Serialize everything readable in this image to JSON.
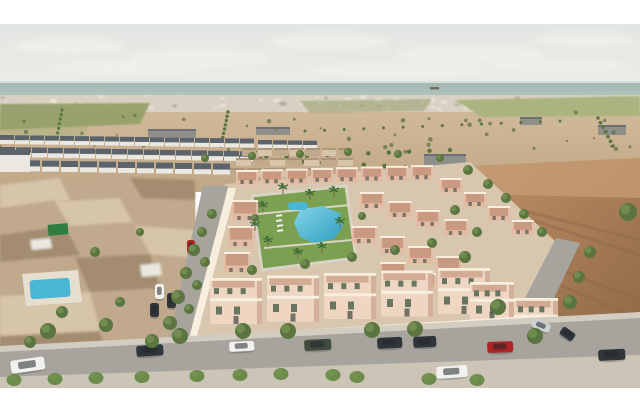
{
  "scene": {
    "type": "aerial-architectural-rendering",
    "subject": "new salmon-coloured villa development with communal pool and park, beside an older town, empty desert plots, distant white town and sea horizon"
  },
  "palette": {
    "frame": "#ffffff",
    "sky_top": "#e2e6e2",
    "sky_bottom": "#edece7",
    "cloud": "#f3f1ec",
    "sea": "#9fb5ae",
    "sea_light": "#b2c4bd",
    "horizon_haze": "#e9ebe3",
    "distant_town": "#d7d0c3",
    "speck_light": "#eae4d7",
    "speck_dark": "#b3ab9c",
    "field_green": "#96a06a",
    "field_green2": "#a9b37c",
    "desert_tan": "#d0b999",
    "desert_tan2": "#c0a685",
    "scrub_dark": "#6d7950",
    "warehouse_grey": "#90908b",
    "roof_dark": "#5c636b",
    "townhouse_white": "#eae8e1",
    "oldtown_brown": "#c0a98c",
    "oldtown_dark": "#a38c6f",
    "oldtown_light": "#d7c5aa",
    "shed_green": "#2f7d3f",
    "road_grey": "#a7a49e",
    "sidewalk": "#d3ccc0",
    "sidewalk_light": "#cbc4b7",
    "dev_ground": "#d9c6af",
    "villa_wall": "#e2bca4",
    "villa_wall_light": "#eed6c2",
    "villa_roof": "#c4937c",
    "villa_trim": "#f7eedd",
    "villa_shadow": "#c08f7a",
    "window_green": "#68765f",
    "window_dark": "#3e4741",
    "lawn": "#7ba052",
    "lawn_light": "#97b66a",
    "path_col": "#d9d3c6",
    "pool_blue": "#49b7d4",
    "pool_deep": "#2d9ec0",
    "pool_light": "#85d5e6",
    "pool_deck": "#e6dfd0",
    "tree_green": "#5a7540",
    "tree_light": "#7b9554",
    "trunk": "#7c644a",
    "palm_green": "#3f6d38",
    "bush_green": "#6b8c4b",
    "dirt_lot": "#aa7e57",
    "dirt_dark": "#8e6847",
    "dirt_light": "#c49b73",
    "car_white": "#f1f1ee",
    "car_red": "#b02424",
    "car_dark": "#2f353a",
    "car_green": "#414b3e",
    "car_silver": "#ccd1d3",
    "car_glass": "#20262a",
    "ship": "#6d6f6a"
  },
  "clouds": [
    [
      70,
      46,
      55,
      8
    ],
    [
      200,
      58,
      70,
      9
    ],
    [
      330,
      42,
      60,
      8
    ],
    [
      470,
      54,
      75,
      9
    ],
    [
      585,
      40,
      50,
      7
    ],
    [
      130,
      68,
      80,
      7
    ],
    [
      400,
      70,
      90,
      7
    ],
    [
      560,
      66,
      70,
      6
    ]
  ],
  "ship": {
    "x": 430,
    "y": 87,
    "w": 9,
    "h": 2.5
  },
  "specks": {
    "count": 85,
    "seed": 7
  },
  "scrub": {
    "count": 48,
    "seed": 13
  },
  "green_fields": [
    {
      "pts": "0,104 150,103 140,124 0,130",
      "c": "field_green",
      "o": 0.95
    },
    {
      "pts": "455,100 640,96 640,116 482,117",
      "c": "field_green2",
      "o": 0.95
    },
    {
      "pts": "300,101 432,99 424,111 310,113",
      "c": "field_green",
      "o": 0.55
    },
    {
      "pts": "0,130 90,126 80,140 0,144",
      "c": "field_green2",
      "o": 0.5
    }
  ],
  "warehouses": [
    {
      "x": 148,
      "y": 129,
      "w": 48,
      "h": 9
    },
    {
      "x": 256,
      "y": 127,
      "w": 34,
      "h": 8
    },
    {
      "x": 424,
      "y": 154,
      "w": 42,
      "h": 13
    },
    {
      "x": 598,
      "y": 125,
      "w": 28,
      "h": 10
    },
    {
      "x": 520,
      "y": 117,
      "w": 22,
      "h": 8
    }
  ],
  "tree_lines": [
    {
      "x1": 62,
      "y1": 110,
      "x2": 56,
      "y2": 142,
      "n": 8,
      "r": 1.6
    },
    {
      "x1": 228,
      "y1": 112,
      "x2": 221,
      "y2": 146,
      "n": 9,
      "r": 1.7
    },
    {
      "x1": 205,
      "y1": 160,
      "x2": 450,
      "y2": 150,
      "n": 13,
      "r": 2.2
    },
    {
      "x1": 240,
      "y1": 158,
      "x2": 632,
      "y2": 180,
      "n": 20,
      "r": 2.4
    },
    {
      "x1": 420,
      "y1": 178,
      "x2": 638,
      "y2": 207,
      "n": 13,
      "r": 3.0
    },
    {
      "x1": 430,
      "y1": 192,
      "x2": 620,
      "y2": 215,
      "n": 11,
      "r": 3.2
    },
    {
      "x1": 598,
      "y1": 118,
      "x2": 613,
      "y2": 146,
      "n": 7,
      "r": 1.8
    },
    {
      "x1": 305,
      "y1": 131,
      "x2": 560,
      "y2": 121,
      "n": 14,
      "r": 1.5
    }
  ],
  "townhouse_rows": [
    {
      "x": 0,
      "y": 135,
      "n": 17,
      "w": 14,
      "g": 1,
      "h": 9,
      "sl": 0.22
    },
    {
      "x": 0,
      "y": 147,
      "n": 16,
      "w": 15,
      "g": 1,
      "h": 10,
      "sl": 0.28
    },
    {
      "x": 4,
      "y": 160,
      "n": 12,
      "w": 17,
      "g": 2,
      "h": 11,
      "sl": 0.32
    },
    {
      "x": 258,
      "y": 140,
      "n": 4,
      "w": 14,
      "g": 1,
      "h": 8,
      "sl": 0.2
    }
  ],
  "midtown_rows": [
    {
      "x": 242,
      "y": 148,
      "n": 7,
      "w": 14,
      "g": 2,
      "h": 8
    },
    {
      "x": 236,
      "y": 158,
      "n": 7,
      "w": 15,
      "g": 2,
      "h": 8
    },
    {
      "x": 230,
      "y": 168,
      "n": 6,
      "w": 15,
      "g": 2,
      "h": 9
    }
  ],
  "oldtown_patches": [
    {
      "pts": "0,185 60,178 70,200 0,208",
      "c": "oldtown_light"
    },
    {
      "pts": "60,180 130,176 140,196 72,202",
      "c": "oldtown_brown"
    },
    {
      "pts": "130,178 195,180 195,200 142,198",
      "c": "oldtown_dark"
    },
    {
      "pts": "0,208 55,200 70,225 0,235",
      "c": "oldtown_brown"
    },
    {
      "pts": "55,202 120,198 132,222 70,226",
      "c": "oldtown_light"
    },
    {
      "pts": "120,200 195,202 195,228 134,224",
      "c": "oldtown_brown"
    },
    {
      "pts": "0,235 65,226 80,255 0,262",
      "c": "oldtown_dark"
    },
    {
      "pts": "65,228 135,224 148,252 82,256",
      "c": "oldtown_brown"
    },
    {
      "pts": "135,226 195,230 195,258 150,254",
      "c": "oldtown_light"
    },
    {
      "pts": "0,262 75,256 88,290 0,296",
      "c": "oldtown_brown"
    },
    {
      "pts": "75,258 150,254 160,288 90,292",
      "c": "oldtown_dark"
    },
    {
      "pts": "0,296 90,292 100,330 0,336",
      "c": "oldtown_light"
    },
    {
      "pts": "90,294 165,290 172,326 102,332",
      "c": "oldtown_brown"
    },
    {
      "pts": "0,336 100,332 108,360 0,362",
      "c": "oldtown_dark"
    },
    {
      "pts": "100,334 178,330 168,360 110,360",
      "c": "oldtown_brown"
    },
    {
      "pts": "30,240 50,238 52,248 32,250",
      "c": "townhouse_white"
    },
    {
      "pts": "140,265 160,263 162,275 142,277",
      "c": "townhouse_white"
    }
  ],
  "dirt_streaks": [
    "M470,200 L640,255",
    "M455,230 L640,300",
    "M480,300 L620,335",
    "M520,210 L640,240",
    "M500,260 L630,315"
  ],
  "villa_rows": [
    {
      "x": 236,
      "y": 170,
      "n": 8,
      "dx": 25,
      "dy": -0.7,
      "w": 22,
      "h": 15,
      "s": "small"
    },
    {
      "x": 232,
      "y": 200,
      "n": 4,
      "dx": -4,
      "dy": 26,
      "w": 26,
      "h": 21,
      "s": "small"
    },
    {
      "x": 360,
      "y": 192,
      "n": 4,
      "dx": 28,
      "dy": 9,
      "w": 24,
      "h": 17,
      "s": "small"
    },
    {
      "x": 352,
      "y": 226,
      "n": 4,
      "dx": 28,
      "dy": 10,
      "w": 25,
      "h": 18,
      "s": "small"
    },
    {
      "x": 380,
      "y": 262,
      "n": 3,
      "dx": 30,
      "dy": 11,
      "w": 26,
      "h": 19,
      "s": "small"
    },
    {
      "x": 440,
      "y": 178,
      "n": 4,
      "dx": 24,
      "dy": 14,
      "w": 22,
      "h": 15,
      "s": "small"
    },
    {
      "x": 210,
      "y": 278,
      "n": 5,
      "dx": 57,
      "dy": -2.5,
      "w": 52,
      "h": 46,
      "s": "front"
    },
    {
      "x": 470,
      "y": 282,
      "n": 2,
      "dx": 44,
      "dy": 16,
      "w": 44,
      "h": 38,
      "s": "front"
    }
  ],
  "park": {
    "lawn": "252,196 346,186 356,258 262,270",
    "paths": [
      "M258,214 L350,205",
      "M264,248 L352,240"
    ],
    "pool": "300,210 322,206 340,213 343,227 334,239 314,243 300,237 294,223",
    "small_pool": {
      "x": 288,
      "y": 202,
      "w": 20,
      "h": 8
    },
    "loungers": [
      [
        276,
        215
      ],
      [
        276,
        220
      ],
      [
        277,
        225
      ],
      [
        277,
        230
      ]
    ]
  },
  "palms": [
    [
      263,
      212
    ],
    [
      268,
      247
    ],
    [
      298,
      259
    ],
    [
      322,
      253
    ],
    [
      340,
      228
    ],
    [
      334,
      197
    ],
    [
      283,
      194
    ],
    [
      255,
      231
    ],
    [
      310,
      200
    ]
  ],
  "trees": [
    [
      48,
      331,
      8
    ],
    [
      106,
      325,
      7
    ],
    [
      180,
      336,
      8
    ],
    [
      243,
      331,
      8
    ],
    [
      288,
      331,
      8
    ],
    [
      372,
      330,
      8
    ],
    [
      415,
      329,
      8
    ],
    [
      498,
      307,
      8
    ],
    [
      535,
      336,
      8
    ],
    [
      570,
      302,
      7
    ],
    [
      628,
      212,
      9
    ],
    [
      590,
      252,
      6
    ],
    [
      579,
      277,
      6
    ],
    [
      212,
      214,
      5
    ],
    [
      202,
      232,
      5
    ],
    [
      194,
      250,
      6
    ],
    [
      205,
      262,
      5
    ],
    [
      186,
      273,
      6
    ],
    [
      197,
      285,
      5
    ],
    [
      178,
      297,
      7
    ],
    [
      189,
      309,
      5
    ],
    [
      170,
      323,
      7
    ],
    [
      152,
      341,
      7
    ],
    [
      95,
      252,
      5
    ],
    [
      62,
      312,
      6
    ],
    [
      120,
      302,
      5
    ],
    [
      30,
      342,
      6
    ],
    [
      140,
      232,
      4
    ],
    [
      252,
      270,
      5
    ],
    [
      305,
      264,
      5
    ],
    [
      352,
      257,
      5
    ],
    [
      395,
      250,
      5
    ],
    [
      432,
      243,
      5
    ],
    [
      362,
      216,
      4
    ],
    [
      255,
      218,
      4
    ],
    [
      465,
      257,
      6
    ],
    [
      477,
      232,
      5
    ],
    [
      455,
      210,
      5
    ],
    [
      205,
      158,
      4
    ],
    [
      252,
      156,
      4
    ],
    [
      300,
      154,
      4
    ],
    [
      348,
      152,
      4
    ],
    [
      398,
      154,
      4
    ],
    [
      440,
      158,
      4
    ],
    [
      468,
      170,
      5
    ],
    [
      488,
      184,
      5
    ],
    [
      506,
      198,
      5
    ],
    [
      524,
      214,
      5
    ],
    [
      542,
      232,
      5
    ]
  ],
  "bushes": [
    [
      14,
      380
    ],
    [
      55,
      379
    ],
    [
      96,
      378
    ],
    [
      142,
      377
    ],
    [
      197,
      376
    ],
    [
      240,
      375
    ],
    [
      281,
      374
    ],
    [
      333,
      375
    ],
    [
      357,
      377
    ],
    [
      429,
      379
    ],
    [
      477,
      380
    ]
  ],
  "cars": [
    {
      "x": 10,
      "y": 361,
      "w": 34,
      "h": 13,
      "c": "car_white",
      "a": -8
    },
    {
      "x": 136,
      "y": 346,
      "w": 27,
      "h": 11,
      "c": "car_dark",
      "a": -4
    },
    {
      "x": 229,
      "y": 342,
      "w": 25,
      "h": 10,
      "c": "car_white",
      "a": -3
    },
    {
      "x": 304,
      "y": 340,
      "w": 27,
      "h": 11,
      "c": "car_green",
      "a": -3
    },
    {
      "x": 377,
      "y": 338,
      "w": 25,
      "h": 11,
      "c": "car_dark",
      "a": -3
    },
    {
      "x": 413,
      "y": 337,
      "w": 23,
      "h": 11,
      "c": "car_dark",
      "a": -3
    },
    {
      "x": 487,
      "y": 342,
      "w": 26,
      "h": 11,
      "c": "car_red",
      "a": -2
    },
    {
      "x": 436,
      "y": 367,
      "w": 31,
      "h": 12,
      "c": "car_white",
      "a": -4
    },
    {
      "x": 598,
      "y": 350,
      "w": 27,
      "h": 11,
      "c": "car_dark",
      "a": -3
    },
    {
      "x": 534,
      "y": 318,
      "w": 19,
      "h": 9,
      "c": "car_silver",
      "a": 22
    },
    {
      "x": 564,
      "y": 326,
      "w": 15,
      "h": 9,
      "c": "car_dark",
      "a": 35
    },
    {
      "x": 155,
      "y": 284,
      "w": 9,
      "h": 15,
      "c": "car_white",
      "a": 0
    },
    {
      "x": 167,
      "y": 293,
      "w": 9,
      "h": 15,
      "c": "car_dark",
      "a": 0
    },
    {
      "x": 150,
      "y": 303,
      "w": 9,
      "h": 14,
      "c": "car_dark",
      "a": 0
    },
    {
      "x": 187,
      "y": 240,
      "w": 8,
      "h": 13,
      "c": "car_red",
      "a": 0
    }
  ]
}
